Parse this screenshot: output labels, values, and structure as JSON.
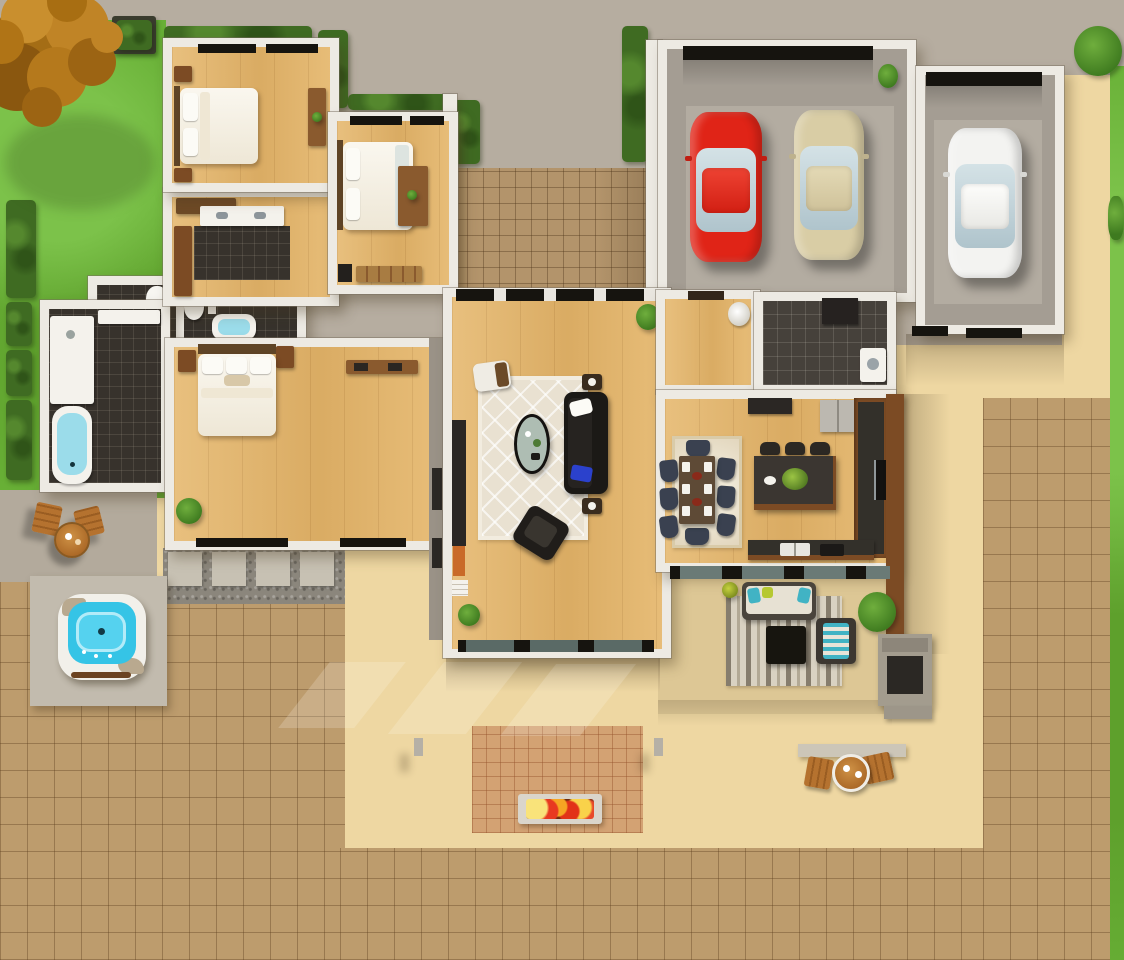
{
  "scene": {
    "type": "3d-floor-plan-top-down-render",
    "canvas": {
      "width": 1124,
      "height": 960
    }
  },
  "palette": {
    "concrete": "#b6ada0",
    "patioGray": "#b3aa9c",
    "garageFloor": "#a49d93",
    "garageSlab": "#b3aca1",
    "sand": "#eed7a2",
    "paver": "#bd9c6d",
    "paverCourt": "#b3946b",
    "terracotta": "#d3a273",
    "grass": "#68b036",
    "grassLight": "#7cc24a",
    "hedge": "#3f6b22",
    "treeA": "#c08426",
    "treeB": "#a46d15",
    "treeC": "#8a570f",
    "wood": "#e5b76c",
    "wall": "#edeae3",
    "tileDark": "#37322c",
    "mudTile": "#46413b",
    "water": "#35c4e6",
    "tubWater": "#9bdcea",
    "carRed": "#e02417",
    "carRedRoof": "#ee4333",
    "carBeige": "#d9cda5",
    "carBeigeRoof": "#e4dab6",
    "carWhite": "#f3f3f1",
    "carWhiteRoof": "#fdfdfb",
    "carGlass": "#c6d6dc",
    "rug": "#e9e1d1",
    "rugStripeDark": "#867d6d",
    "rugStripeLight": "#d9d2c2",
    "sofa": "#1b1916",
    "pillowBlue": "#2b41cc",
    "tableWood": "#5e4a36",
    "chairNavy": "#3a4150",
    "islandTop": "#3b3631",
    "cabinetWood": "#7c4b24",
    "counterDark": "#33302a",
    "fridge": "#bcb8b0",
    "flameRed": "#e83920",
    "flameOrange": "#f6a623",
    "flameYellow": "#f9e37a",
    "outdoorWood": "#b5722f",
    "teal": "#41b3c4",
    "lime": "#b6c832",
    "ledge": "#ccc6b8",
    "gravel": "#8b867c",
    "slab": "#c7c1b3",
    "firebox": "#2b2824",
    "glassBand": "#16140f"
  },
  "legend": {
    "rooms": [
      "bedroom-1",
      "bedroom-2",
      "closet-hall",
      "shared-bathroom",
      "toilet-rooms",
      "master-bathroom",
      "master-bedroom",
      "living-room",
      "foyer",
      "mudroom-laundry",
      "dining-area",
      "kitchen",
      "garage"
    ],
    "vehicles": [
      "red-car",
      "beige-car",
      "white-car"
    ],
    "outdoor": [
      "autumn-tree",
      "lawn",
      "hedges",
      "planter-box",
      "entry-courtyard",
      "concrete-driveway",
      "paver-patio",
      "sand-patio",
      "hot-tub",
      "fire-pit",
      "terracotta-pad",
      "covered-patio-lounge",
      "outdoor-fireplace",
      "bistro-set-garden",
      "bistro-set-patio",
      "stepping-stones"
    ]
  }
}
